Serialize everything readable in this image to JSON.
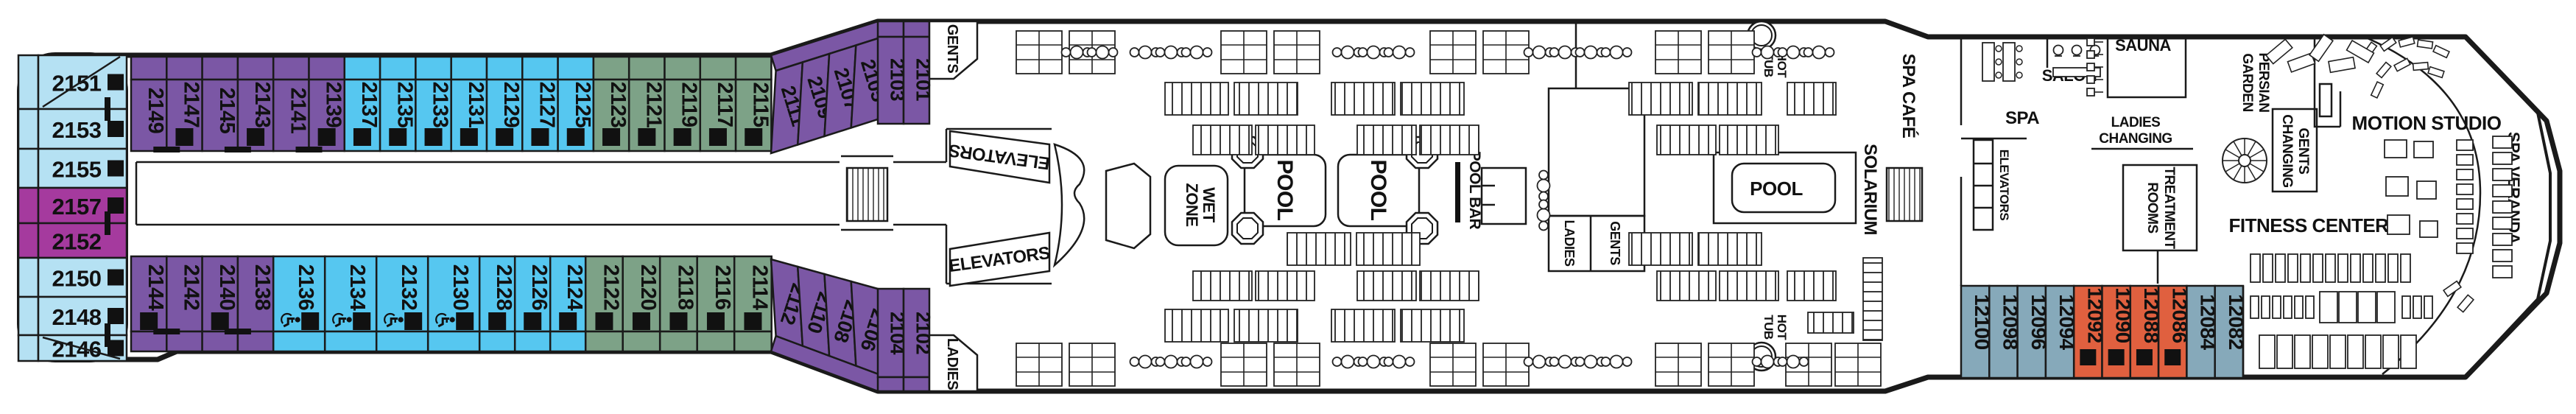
{
  "deck": {
    "type": "cruise-ship-deck-plan"
  },
  "palette": {
    "light_blue": "#b5e1f3",
    "magenta": "#a53a9e",
    "purple": "#7b57a5",
    "blue": "#56c7f0",
    "green": "#7da287",
    "slate": "#86a9ba",
    "orange": "#e0603f",
    "outline": "#1a1a1a",
    "indicator": "#111111"
  },
  "labels": {
    "gents": "GENTS",
    "ladies": "LADIES",
    "elevators": "ELEVATORS",
    "wet_zone": [
      "WET",
      "ZONE"
    ],
    "pool": "POOL",
    "pool_bar": "POOL BAR",
    "solarium": "SOLARIUM",
    "hot_tub": [
      "HOT",
      "TUB"
    ],
    "spa_cafe": "SPA CAFÉ",
    "spa": "SPA",
    "salon": "SALON",
    "sauna": "SAUNA",
    "ladies_changing": [
      "LADIES",
      "CHANGING"
    ],
    "persian_garden": [
      "PERSIAN",
      "GARDEN"
    ],
    "gents_changing": [
      "GENTS",
      "CHANGING"
    ],
    "treatment_rooms": [
      "TREATMENT",
      "ROOMS"
    ],
    "fitness_center": "FITNESS CENTER",
    "motion_studio": "MOTION STUDIO",
    "spa_veranda": "SPA VERANDA"
  },
  "cabins": {
    "left_block": [
      {
        "number": "2151",
        "category": "light_blue",
        "sofa_bed": true
      },
      {
        "number": "2153",
        "category": "light_blue",
        "sofa_bed": true
      },
      {
        "number": "2155",
        "category": "light_blue",
        "sofa_bed": true
      },
      {
        "number": "2157",
        "category": "magenta",
        "sofa_bed": true
      },
      {
        "number": "2152",
        "category": "magenta",
        "sofa_bed": false
      },
      {
        "number": "2150",
        "category": "light_blue",
        "sofa_bed": true
      },
      {
        "number": "2148",
        "category": "light_blue",
        "sofa_bed": true
      },
      {
        "number": "2146",
        "category": "light_blue",
        "sofa_bed": true
      }
    ],
    "top_row": [
      {
        "number": "2149",
        "category": "purple",
        "sofa_bed": false
      },
      {
        "number": "2147",
        "category": "purple",
        "sofa_bed": true
      },
      {
        "number": "2145",
        "category": "purple",
        "sofa_bed": false
      },
      {
        "number": "2143",
        "category": "purple",
        "sofa_bed": true
      },
      {
        "number": "2141",
        "category": "purple",
        "sofa_bed": false
      },
      {
        "number": "2139",
        "category": "purple",
        "sofa_bed": true
      },
      {
        "number": "2137",
        "category": "blue",
        "sofa_bed": true
      },
      {
        "number": "2135",
        "category": "blue",
        "sofa_bed": true
      },
      {
        "number": "2133",
        "category": "blue",
        "sofa_bed": true
      },
      {
        "number": "2131",
        "category": "blue",
        "sofa_bed": true
      },
      {
        "number": "2129",
        "category": "blue",
        "sofa_bed": true
      },
      {
        "number": "2127",
        "category": "blue",
        "sofa_bed": true
      },
      {
        "number": "2125",
        "category": "blue",
        "sofa_bed": true
      },
      {
        "number": "2123",
        "category": "green",
        "sofa_bed": true
      },
      {
        "number": "2121",
        "category": "green",
        "sofa_bed": true
      },
      {
        "number": "2119",
        "category": "green",
        "sofa_bed": true
      },
      {
        "number": "2117",
        "category": "green",
        "sofa_bed": true
      },
      {
        "number": "2115",
        "category": "green",
        "sofa_bed": true
      }
    ],
    "top_slant": [
      {
        "number": "2111",
        "category": "purple",
        "sofa_bed": false
      },
      {
        "number": "2109",
        "category": "purple",
        "sofa_bed": false
      },
      {
        "number": "2107",
        "category": "purple",
        "sofa_bed": false
      },
      {
        "number": "2105",
        "category": "purple",
        "sofa_bed": false
      },
      {
        "number": "2103",
        "category": "purple",
        "sofa_bed": false
      },
      {
        "number": "2101",
        "category": "purple",
        "sofa_bed": false
      }
    ],
    "bottom_row": [
      {
        "number": "2144",
        "category": "purple",
        "sofa_bed": true
      },
      {
        "number": "2142",
        "category": "purple",
        "sofa_bed": false
      },
      {
        "number": "2140",
        "category": "purple",
        "sofa_bed": true
      },
      {
        "number": "2138",
        "category": "purple",
        "sofa_bed": false
      },
      {
        "number": "2136",
        "category": "blue",
        "sofa_bed": true,
        "wheelchair": true
      },
      {
        "number": "2134",
        "category": "blue",
        "sofa_bed": true,
        "wheelchair": true
      },
      {
        "number": "2132",
        "category": "blue",
        "sofa_bed": true,
        "wheelchair": true
      },
      {
        "number": "2130",
        "category": "blue",
        "sofa_bed": true,
        "wheelchair": true
      },
      {
        "number": "2128",
        "category": "blue",
        "sofa_bed": true
      },
      {
        "number": "2126",
        "category": "blue",
        "sofa_bed": true
      },
      {
        "number": "2124",
        "category": "blue",
        "sofa_bed": true
      },
      {
        "number": "2122",
        "category": "green",
        "sofa_bed": true
      },
      {
        "number": "2120",
        "category": "green",
        "sofa_bed": true
      },
      {
        "number": "2118",
        "category": "green",
        "sofa_bed": true
      },
      {
        "number": "2116",
        "category": "green",
        "sofa_bed": true
      },
      {
        "number": "2114",
        "category": "green",
        "sofa_bed": true
      }
    ],
    "bottom_slant": [
      {
        "number": "2112",
        "category": "purple",
        "sofa_bed": false
      },
      {
        "number": "2110",
        "category": "purple",
        "sofa_bed": false
      },
      {
        "number": "2108",
        "category": "purple",
        "sofa_bed": false
      },
      {
        "number": "2106",
        "category": "purple",
        "sofa_bed": false
      },
      {
        "number": "2104",
        "category": "purple",
        "sofa_bed": false
      },
      {
        "number": "2102",
        "category": "purple",
        "sofa_bed": false
      }
    ],
    "spa_row": [
      {
        "number": "12100",
        "category": "slate",
        "sofa_bed": false
      },
      {
        "number": "12098",
        "category": "slate",
        "sofa_bed": false
      },
      {
        "number": "12096",
        "category": "slate",
        "sofa_bed": false
      },
      {
        "number": "12094",
        "category": "slate",
        "sofa_bed": false
      },
      {
        "number": "12092",
        "category": "orange",
        "sofa_bed": true
      },
      {
        "number": "12090",
        "category": "orange",
        "sofa_bed": true
      },
      {
        "number": "12088",
        "category": "orange",
        "sofa_bed": true
      },
      {
        "number": "12086",
        "category": "orange",
        "sofa_bed": true
      },
      {
        "number": "12084",
        "category": "slate",
        "sofa_bed": false
      },
      {
        "number": "12082",
        "category": "slate",
        "sofa_bed": false
      }
    ]
  }
}
